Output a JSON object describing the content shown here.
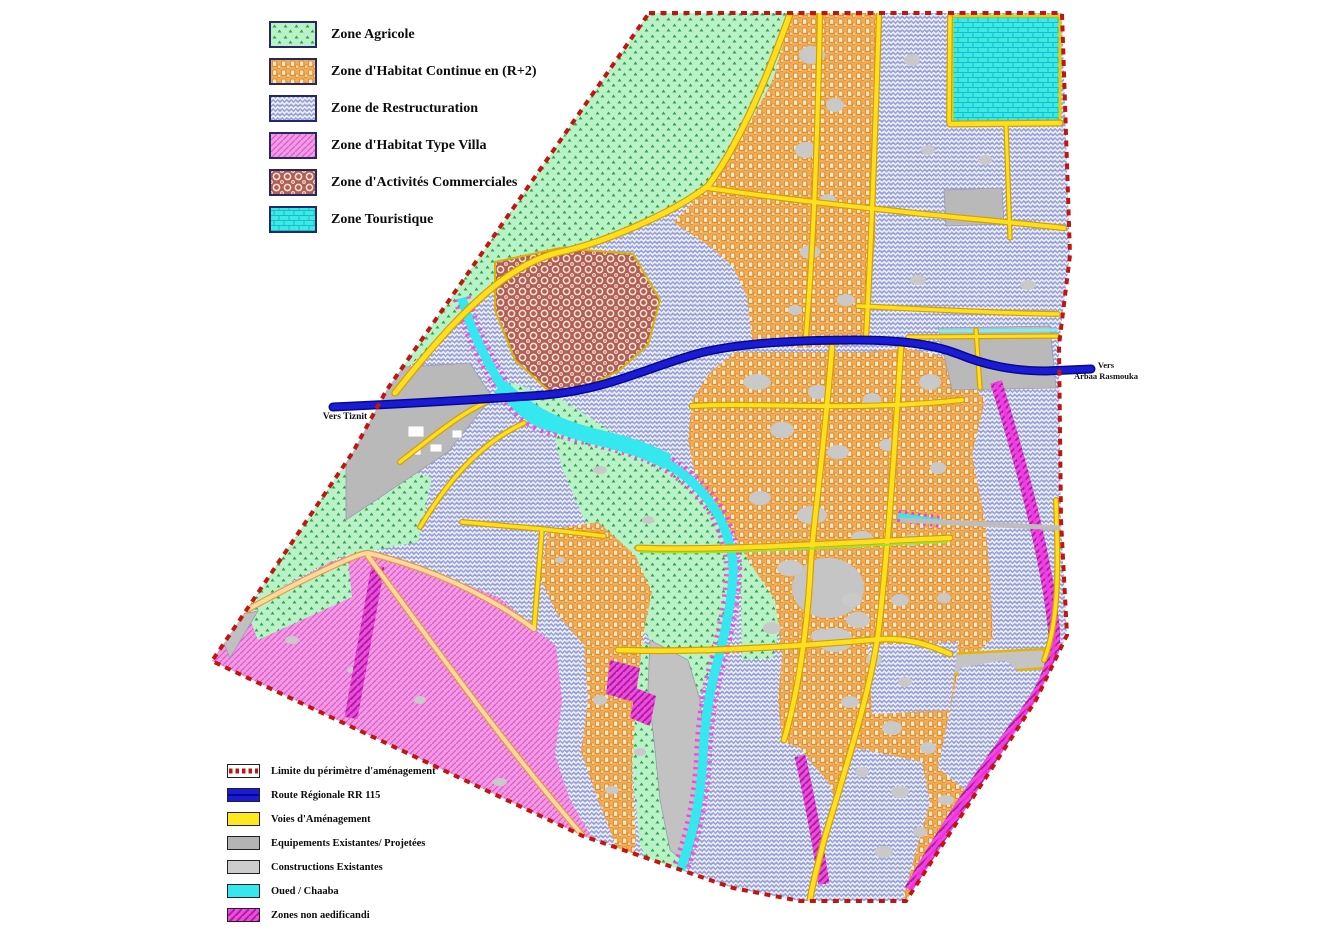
{
  "document": {
    "type": "urban zoning / development plan map",
    "language": "French"
  },
  "legend_zones": {
    "items": [
      {
        "id": "agricole",
        "label": "Zone Agricole",
        "color": "#b9f2c6",
        "pattern": "green-triangles"
      },
      {
        "id": "habitat",
        "label": "Zone d'Habitat Continue en (R+2)",
        "color": "#f2ac58",
        "pattern": "orange-chain-squares"
      },
      {
        "id": "restructuration",
        "label": "Zone de Restructuration",
        "color": "#9aa3d6",
        "pattern": "blue-herringbone"
      },
      {
        "id": "villa",
        "label": "Zone d'Habitat Type Villa",
        "color": "#f49ae5",
        "pattern": "pink-diagonal-dashes"
      },
      {
        "id": "commerciales",
        "label": "Zone d'Activités Commerciales",
        "color": "#b25e58",
        "pattern": "red-hex-rings"
      },
      {
        "id": "touristique",
        "label": "Zone Touristique",
        "color": "#3fe9e2",
        "pattern": "cyan-bricks"
      }
    ]
  },
  "legend_symbols": {
    "items": [
      {
        "id": "limite",
        "label": "Limite du périmètre d'aménagement",
        "color": "#c41410",
        "style": "red-dashed-line"
      },
      {
        "id": "route",
        "label": "Route Régionale RR 115",
        "color": "#1b1bd6",
        "style": "blue-band"
      },
      {
        "id": "voies",
        "label": "Voies d'Aménagement",
        "color": "#ffe81f",
        "style": "yellow-band"
      },
      {
        "id": "equipements",
        "label": "Equipements Existantes/ Projetées",
        "color": "#b4b4b4",
        "style": "gray-band"
      },
      {
        "id": "constructions",
        "label": "Constructions Existantes",
        "color": "#cccccc",
        "style": "light-gray-band"
      },
      {
        "id": "oued",
        "label": "Oued / Chaaba",
        "color": "#35e7ef",
        "style": "cyan-band"
      },
      {
        "id": "non_aedificandi",
        "label": "Zones non aedificandi",
        "color": "#f447e7",
        "style": "magenta-hatch-band"
      }
    ]
  },
  "map_labels": {
    "west": "Vers Tiznit",
    "east_line1": "Vers",
    "east_line2": "Arbaa Rasmouka"
  },
  "colors": {
    "perimeter": "#c41410",
    "regional_road": "#1b1bd6",
    "planning_road": "#ffdf1e",
    "oued": "#35e7ef",
    "non_aedificandi": "#f447e7",
    "equipment_gray": "#b4b4b4",
    "constructions_gray": "#c8c8c8"
  }
}
